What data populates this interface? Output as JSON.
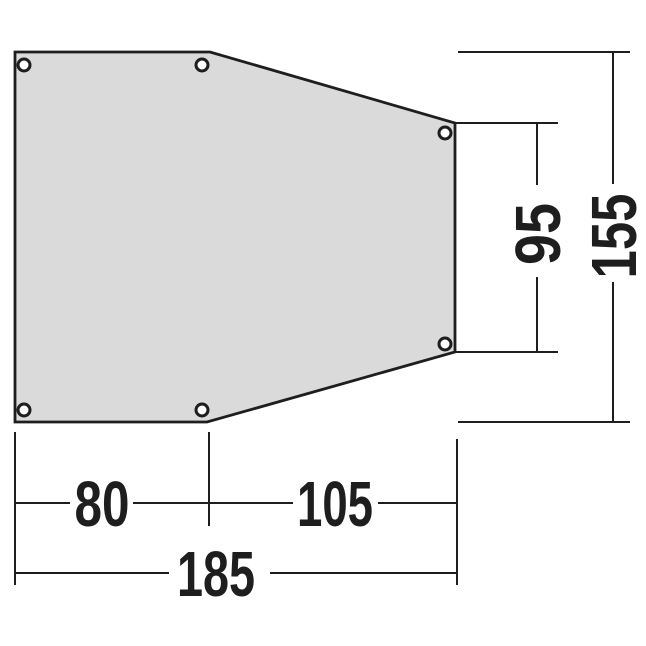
{
  "colors": {
    "background": "#ffffff",
    "shape_fill": "#dadada",
    "line": "#1e1e1e",
    "grommet_fill": "#ffffff"
  },
  "dimensions": {
    "bottom_left_width": "80",
    "bottom_right_width": "105",
    "bottom_total_width": "185",
    "right_inner_height": "95",
    "right_total_height": "155"
  },
  "grommets": {
    "count": 6
  }
}
